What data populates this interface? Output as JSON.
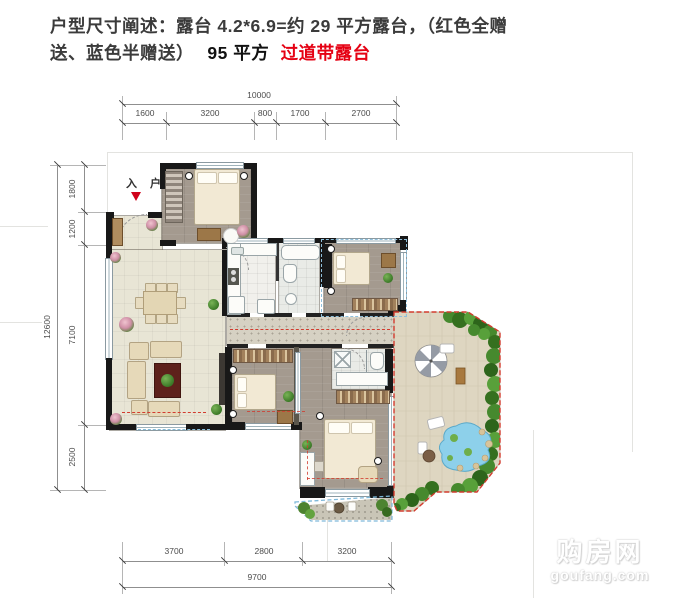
{
  "header": {
    "line1": "户型尺寸阐述：露台 4.2*6.9=约 29 平方露台，（红色全赠",
    "line2a": "送、蓝色半赠送）",
    "line2b": "95 平方",
    "line2c": "过道带露台"
  },
  "plan": {
    "entry_label": "入 户",
    "dims": {
      "top": {
        "total": "10000",
        "segments": [
          "1600",
          "3200",
          "800",
          "1700",
          "2700"
        ]
      },
      "left": {
        "total": "12600",
        "segments": [
          "1800",
          "1200",
          "7100",
          "2500"
        ]
      },
      "bottom": {
        "total": "9700",
        "segments": [
          "3700",
          "2800",
          "3200"
        ]
      }
    }
  },
  "watermark": {
    "name": "购房网",
    "domain": "goufang.com"
  },
  "colors": {
    "highlight_red": "#e50113",
    "gift_red_dash": "#d23b2e",
    "half_gift_blue_dash": "#85bdda",
    "wall_black": "#181818",
    "shrub_green": "#3f7d2a",
    "pool_blue": "#8dd0ea"
  }
}
